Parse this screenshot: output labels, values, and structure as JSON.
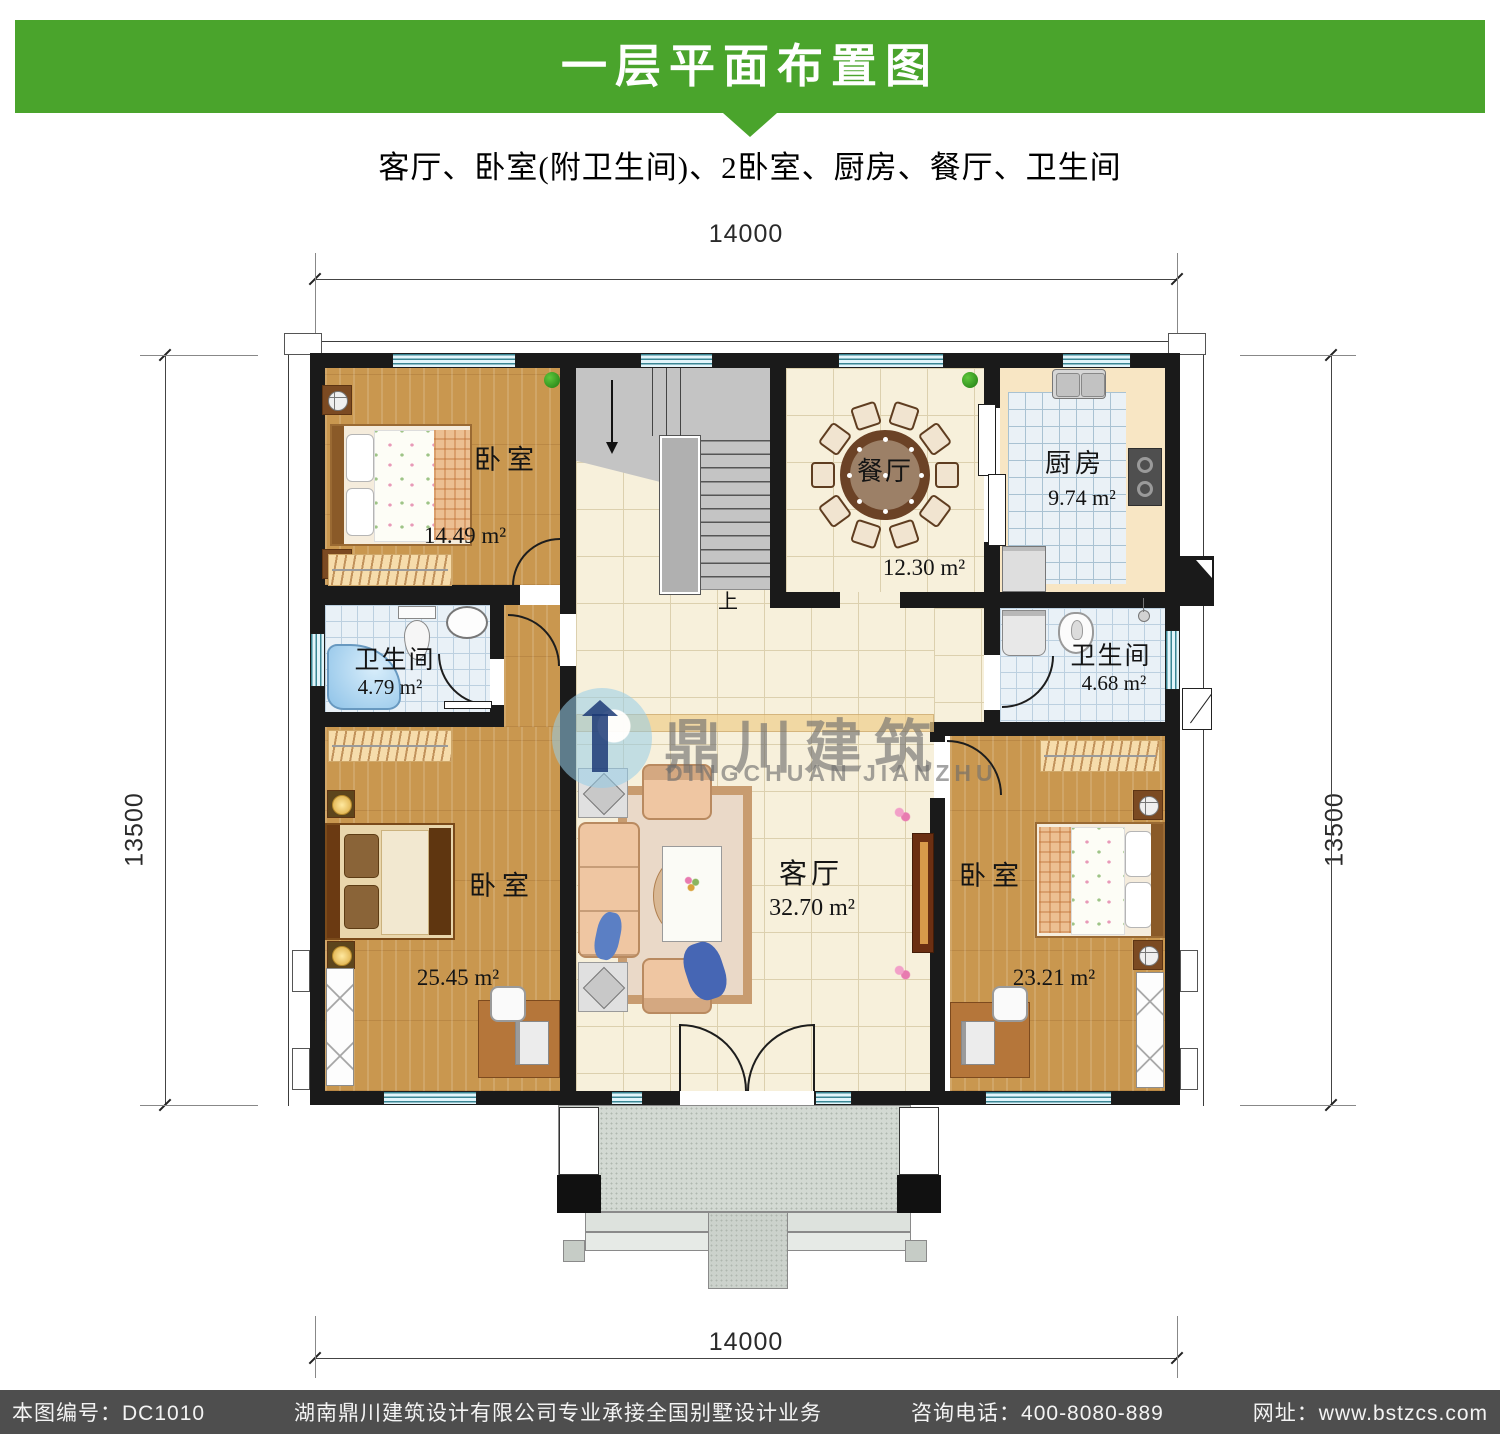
{
  "header": {
    "title": "一层平面布置图",
    "subtitle": "客厅、卧室(附卫生间)、2卧室、厨房、餐厅、卫生间",
    "banner_color": "#4aa42c"
  },
  "dimensions": {
    "width_top": "14000",
    "width_bottom": "14000",
    "height_left": "13500",
    "height_right": "13500"
  },
  "rooms": {
    "bedroom_top_left": {
      "label": "卧室",
      "area": "14.49 m²"
    },
    "bathroom_left": {
      "label": "卫生间",
      "area": "4.79 m²"
    },
    "bedroom_bottom_left": {
      "label": "卧室",
      "area": "25.45 m²"
    },
    "dining_room": {
      "label": "餐厅",
      "area": "12.30 m²"
    },
    "kitchen": {
      "label": "厨房",
      "area": "9.74 m²"
    },
    "bathroom_right": {
      "label": "卫生间",
      "area": "4.68 m²"
    },
    "living_room": {
      "label": "客厅",
      "area": "32.70 m²"
    },
    "bedroom_bottom_right": {
      "label": "卧室",
      "area": "23.21 m²"
    }
  },
  "stairs": {
    "direction_label": "上"
  },
  "watermark": {
    "name_cn": "鼎川建筑",
    "name_en": "DINGCHUAN JIANZHU"
  },
  "footer": {
    "drawing_no": "本图编号：DC1010",
    "company": "湖南鼎川建筑设计有限公司专业承接全国别墅设计业务",
    "phone": "咨询电话：400-8080-889",
    "website": "网址：www.bstzcs.com"
  }
}
